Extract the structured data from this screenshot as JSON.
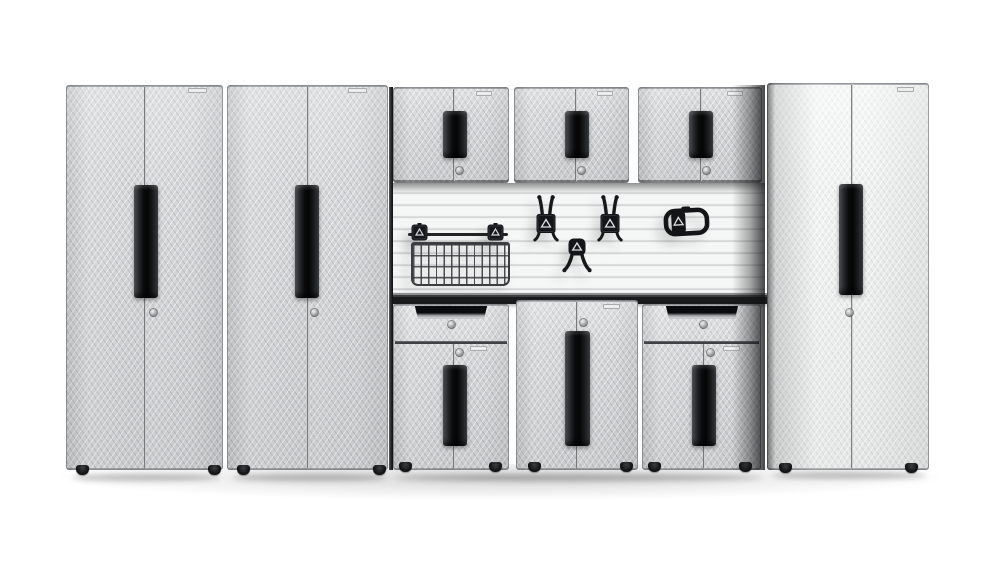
{
  "scene": {
    "type": "product-photo",
    "subject": "Modular garage storage system with diamond-plate steel cabinets, slatwall accessories and workbench",
    "background_color": "#ffffff",
    "readable_text": "none (nameplates too small to read)"
  },
  "palette": {
    "cabinet_silver": "#d2d4d6",
    "cabinet_bright_silver": "#eceeee",
    "handle_black": "#0a0b0c",
    "slatwall_light": "#f5f6f6",
    "slat_groove": "#c8cacb",
    "workbench_dark": "#191a1b",
    "accessory_black": "#17181a",
    "nameplate": "#eceded",
    "lock_silver": "#a7aaac"
  },
  "components": {
    "tall_lockers": [
      {
        "name": "tall-gear-locker-far-left",
        "doors": 2,
        "handle": "long-vertical-black-bar",
        "lock": true,
        "nameplate": true,
        "feet": 2
      },
      {
        "name": "tall-gear-locker-left",
        "doors": 2,
        "handle": "long-vertical-black-bar",
        "lock": true,
        "nameplate": true,
        "feet": 2
      },
      {
        "name": "tall-gear-locker-right",
        "doors": 2,
        "handle": "long-vertical-black-bar",
        "lock": true,
        "nameplate": true,
        "feet": 2,
        "finish": "brighter"
      }
    ],
    "wall_gearboxes": [
      {
        "name": "wall-gearbox-left",
        "doors": 2,
        "handle": "vertical-black-bar",
        "lock": true,
        "nameplate": true
      },
      {
        "name": "wall-gearbox-center",
        "doors": 2,
        "handle": "vertical-black-bar",
        "lock": true,
        "nameplate": true
      },
      {
        "name": "wall-gearbox-right",
        "doors": 2,
        "handle": "vertical-black-bar",
        "lock": true,
        "nameplate": true
      }
    ],
    "base_units": [
      {
        "name": "drawer-base-cabinet-left",
        "drawers": 1,
        "doors": 2,
        "locks": 2,
        "drawer_pull": "recessed-black",
        "nameplate": true,
        "feet": 2
      },
      {
        "name": "center-gearbox-cabinet",
        "doors": 2,
        "locks": 1,
        "handle": "tall-vertical-black-bar",
        "nameplate": true,
        "feet": 2
      },
      {
        "name": "drawer-base-cabinet-right",
        "drawers": 1,
        "doors": 2,
        "locks": 2,
        "drawer_pull": "recessed-black",
        "nameplate": true,
        "feet": 2
      }
    ],
    "workbench": {
      "name": "workbench-top",
      "finish": "dark-steel"
    },
    "slatwall": {
      "name": "slatwall-panel",
      "pattern": "horizontal-slats"
    },
    "accessories": [
      {
        "name": "wire-basket",
        "mount": "slatwall",
        "brackets": 2,
        "crossbar": true
      },
      {
        "name": "twin-prong-hook-left",
        "type": "double-prong-up"
      },
      {
        "name": "twin-prong-hook-right",
        "type": "double-prong-up"
      },
      {
        "name": "curved-down-hook",
        "type": "double-prong-down"
      },
      {
        "name": "loop-handle-hook",
        "type": "closed-loop-holder"
      }
    ]
  }
}
